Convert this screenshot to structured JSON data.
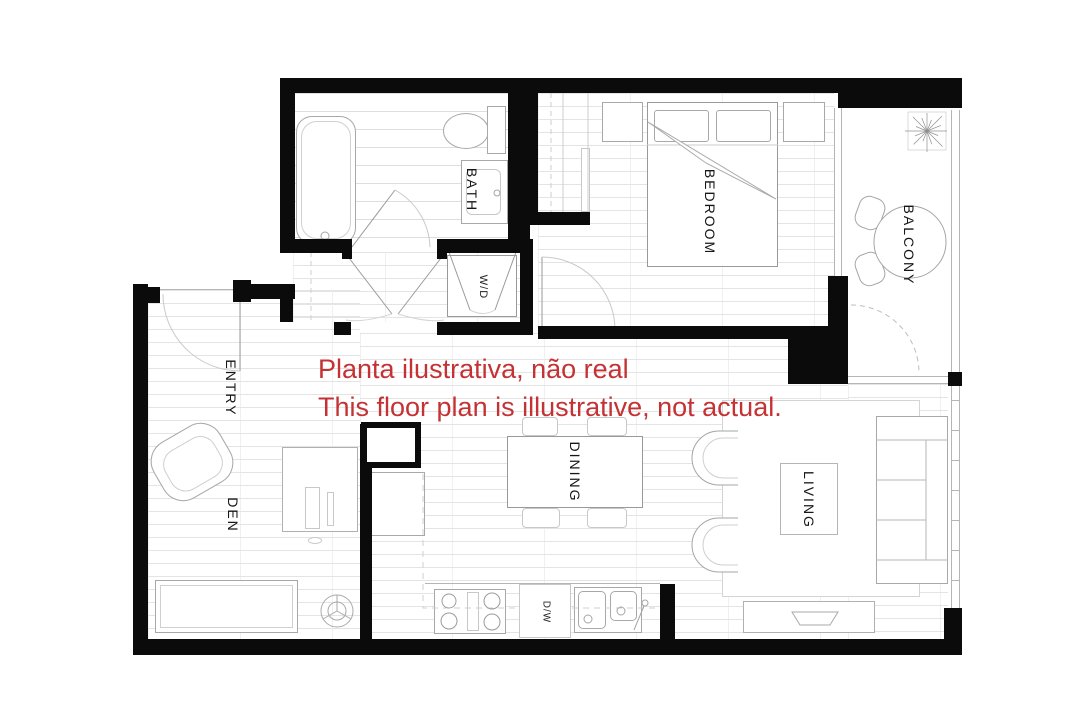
{
  "disclaimer": {
    "line1": "Planta ilustrativa, não real",
    "line2": "This floor plan is illustrative, not actual.",
    "color": "#c43234"
  },
  "rooms": {
    "bath": "BATH",
    "washer_dryer": "W/D",
    "bedroom": "BEDROOM",
    "balcony": "BALCONY",
    "entry": "ENTRY",
    "den": "DEN",
    "dining": "DINING",
    "living": "LIVING",
    "dishwasher": "D/W"
  },
  "colors": {
    "wall": "#0b0b0b",
    "label_text": "#161616",
    "disclaimer_red": "#c43234",
    "floor_line": "#e4e4e4",
    "furniture_line": "#a8a8a8",
    "background": "#ffffff"
  }
}
